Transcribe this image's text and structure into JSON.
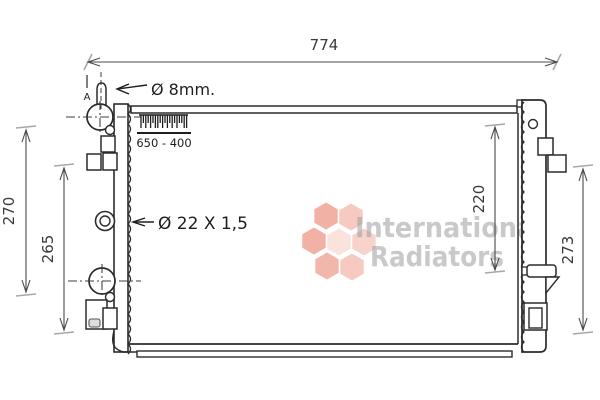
{
  "drawing": {
    "type": "radiator technical drawing"
  },
  "dimensions": {
    "width": "774",
    "left_outer_height": "270",
    "left_inner_height": "265",
    "right_inner_height": "220",
    "right_outer_height": "273"
  },
  "annotations": {
    "bleed_valve": "Ø 8mm.",
    "pipe_size": "Ø 22 X 1,5",
    "core_size": "650 - 400",
    "section_marker": "A"
  },
  "watermark": {
    "line1": "International",
    "line2": "Radiators",
    "text_color": "#9e9e9e",
    "logo_color": "#ee9e8d"
  },
  "colors": {
    "line": "#2b2b2b",
    "dimension_line": "#4a4a4a",
    "extension_tick": "#a8a8a8",
    "background": "#ffffff"
  }
}
